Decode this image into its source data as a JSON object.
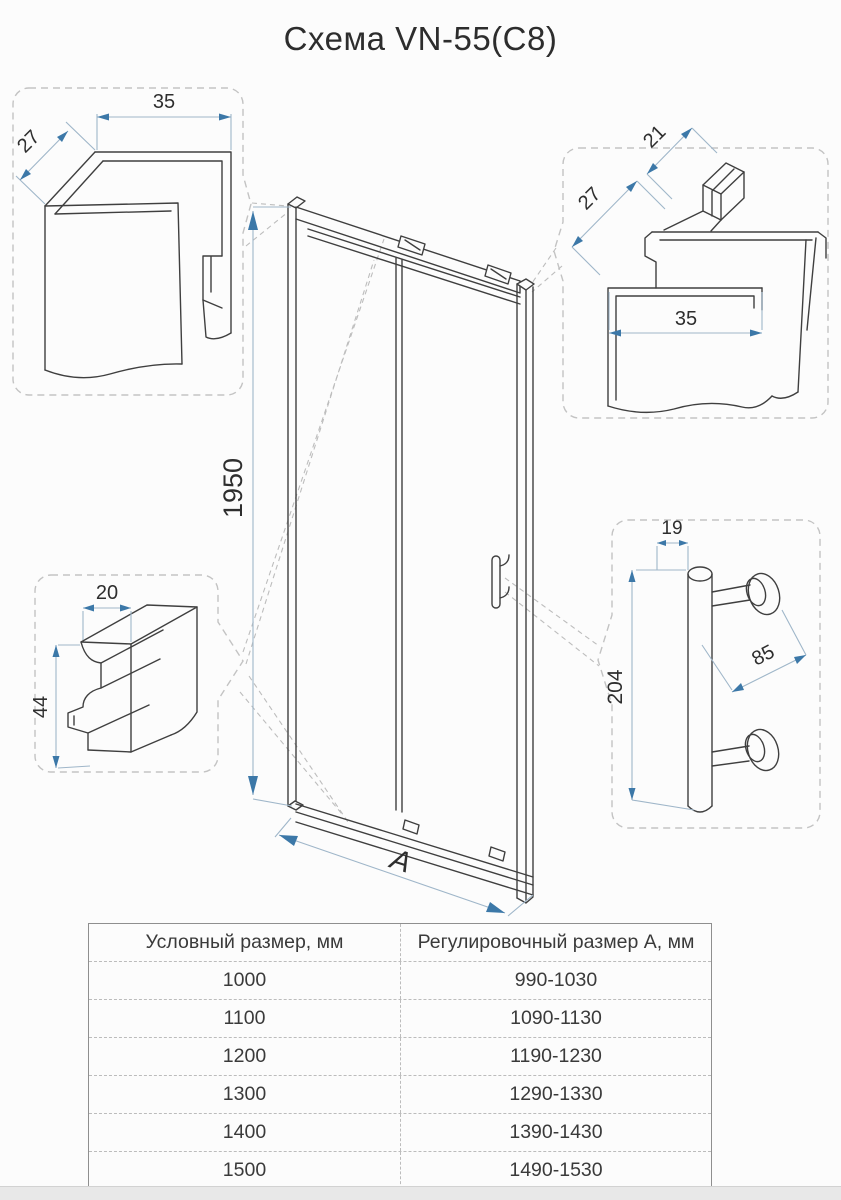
{
  "title": "Схема VN-55(C8)",
  "details": {
    "wall_profile_top_left": {
      "width": "35",
      "depth": "27"
    },
    "wall_profile_top_right": {
      "depth": "27",
      "tab": "21",
      "width": "35"
    },
    "bottom_rail_profile": {
      "width": "20",
      "height": "44"
    },
    "handle": {
      "diameter": "19",
      "length": "204",
      "spacing": "85"
    }
  },
  "door": {
    "height": "1950",
    "width_label": "A"
  },
  "table": {
    "headers": [
      "Условный размер, мм",
      "Регулировочный размер А, мм"
    ],
    "rows": [
      [
        "1000",
        "990-1030"
      ],
      [
        "1100",
        "1090-1130"
      ],
      [
        "1200",
        "1190-1230"
      ],
      [
        "1300",
        "1290-1330"
      ],
      [
        "1400",
        "1390-1430"
      ],
      [
        "1500",
        "1490-1530"
      ]
    ]
  },
  "colors": {
    "line": "#3f3f3f",
    "dim_accent": "#3c78a8",
    "dim_line": "#9fb6c9",
    "callout_border": "#c3c3c3"
  }
}
